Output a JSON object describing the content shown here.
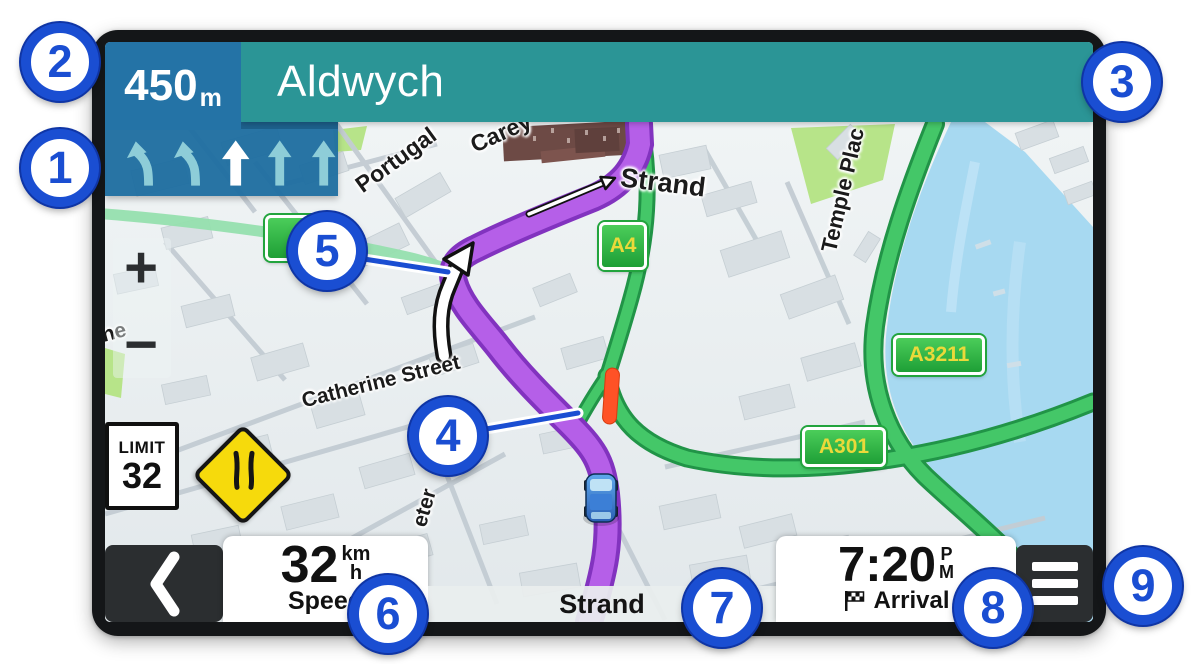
{
  "figure": {
    "description": "Navigation device screen with numbered callouts"
  },
  "header": {
    "distance_value": "450",
    "distance_unit": "m",
    "instruction_street": "Aldwych"
  },
  "lane_guidance": {
    "lane_count": 5,
    "lanes": [
      "curve-left",
      "curve-left",
      "straight-active",
      "straight",
      "straight"
    ]
  },
  "map": {
    "street_labels": [
      {
        "text": "Portugal"
      },
      {
        "text": "Carey"
      },
      {
        "text": "Strand"
      },
      {
        "text": "Temple Plac"
      },
      {
        "text": "Catherine Street"
      },
      {
        "text": "eter"
      },
      {
        "text": "ne"
      }
    ],
    "road_shields": [
      {
        "text": "A4"
      },
      {
        "text": "A3211"
      },
      {
        "text": "A301"
      },
      {
        "text": ""
      }
    ],
    "speed_limit_sign": {
      "title": "LIMIT",
      "value": "32"
    },
    "warning_sign": "road-narrows",
    "traffic_segment": "congestion"
  },
  "zoom_controls": {
    "zoom_in": "+",
    "zoom_out": "−"
  },
  "dashboard": {
    "back_button": "chevron-left",
    "speed": {
      "value": "32",
      "unit_top": "km",
      "unit_bottom": "h",
      "label": "Speed"
    },
    "current_road": "Strand",
    "arrival": {
      "time": "7:20",
      "meridiem_top": "P",
      "meridiem_bottom": "M",
      "label": "Arrival",
      "icon": "checkered-flag"
    },
    "menu_button": "hamburger"
  },
  "callouts": [
    {
      "number": "1"
    },
    {
      "number": "2"
    },
    {
      "number": "3"
    },
    {
      "number": "4"
    },
    {
      "number": "5"
    },
    {
      "number": "6"
    },
    {
      "number": "7"
    },
    {
      "number": "8"
    },
    {
      "number": "9"
    }
  ],
  "colors": {
    "header_teal": "#2b9596",
    "distance_blue": "#2473a6",
    "lane_panel_blue": "#1f6ea0",
    "route_purple": "#b55fe8",
    "road_green": "#3fc163",
    "water_blue": "#a7d9f1",
    "callout_blue": "#1a4ed2",
    "traffic_red": "#ff5226",
    "warning_yellow": "#f6da0c",
    "park_green": "#b7e489"
  }
}
